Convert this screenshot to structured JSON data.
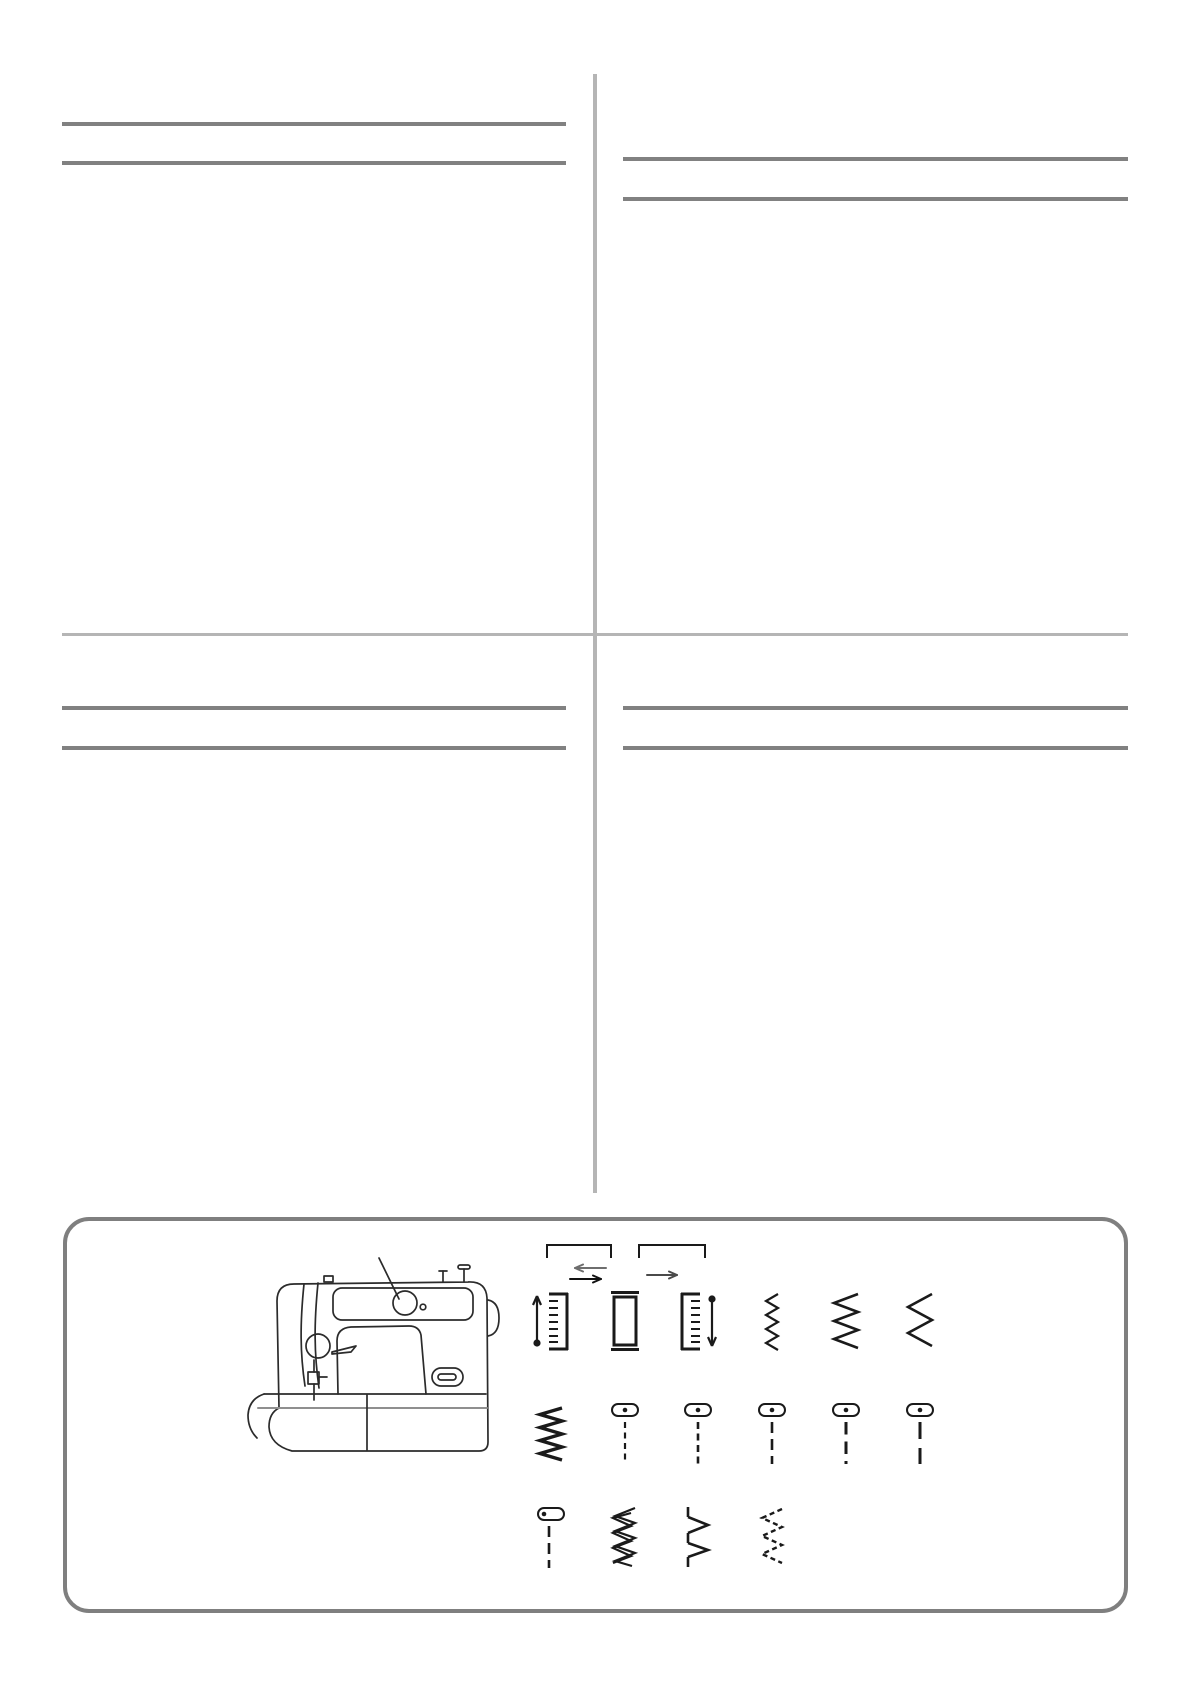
{
  "document": {
    "kind": "sewing-machine manual page",
    "visible_text_blocks": 0,
    "layout": "two columns of heading rules above a rounded stitch-reference panel"
  },
  "colors": {
    "background": "#ffffff",
    "rule_dark": "#818181",
    "rule_light": "#b5b5b5",
    "panel_border": "#7f7f7f",
    "ink": "#1a1a1a"
  },
  "panel": {
    "illustration": "sewing-machine-side-view",
    "callout": "pattern-selector-dial",
    "groups": [
      {
        "bracket": "buttonhole-group-left",
        "arrow": "double-arrow-left-right"
      },
      {
        "bracket": "buttonhole-group-right",
        "arrow": "arrow-right"
      }
    ],
    "stitch_rows": [
      [
        "buttonhole-left-column",
        "buttonhole-end-bartack",
        "buttonhole-right-column",
        "zigzag-narrow",
        "zigzag-medium",
        "zigzag-wide"
      ],
      [
        "zigzag-dense-satin",
        "stretch-straight-fine-dash",
        "stretch-straight-short-dash",
        "stretch-straight-medium-dash",
        "stretch-straight-long-dash",
        "stretch-straight-longest-dash"
      ],
      [
        "stretch-straight-left-needle",
        "elastic-overlock",
        "blind-hem",
        "zigzag-dashed"
      ]
    ]
  }
}
